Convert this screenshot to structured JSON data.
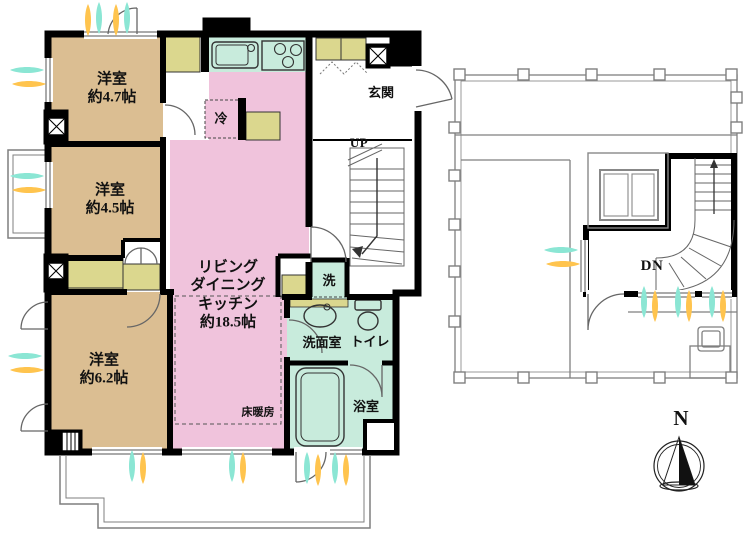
{
  "plan": {
    "left": {
      "bedroom1": {
        "name": "洋室",
        "size": "約4.7帖"
      },
      "bedroom2": {
        "name": "洋室",
        "size": "約4.5帖"
      },
      "bedroom3": {
        "name": "洋室",
        "size": "約6.2帖"
      },
      "ldk": {
        "line1": "リビング",
        "line2": "ダイニング",
        "line3": "キッチン",
        "line4": "約18.5帖"
      },
      "entrance": "玄関",
      "stairs": "UP",
      "laundry": "洗",
      "washroom": "洗面室",
      "toilet": "トイレ",
      "bathroom": "浴室",
      "floor_heating": "床暖房",
      "fridge": "冷"
    },
    "right": {
      "stairs": "DN"
    },
    "compass": {
      "north": "N"
    }
  },
  "colors": {
    "room_tan": "#DBBE92",
    "ldk_pink": "#F0C3DC",
    "wet_mint": "#C8EBDC",
    "closet_khaki": "#DBD78E",
    "wall": "#000000",
    "vent_teal": "#8BE6D4",
    "vent_yellow": "#FFC44E",
    "outline_gray": "#7f7f7f"
  }
}
